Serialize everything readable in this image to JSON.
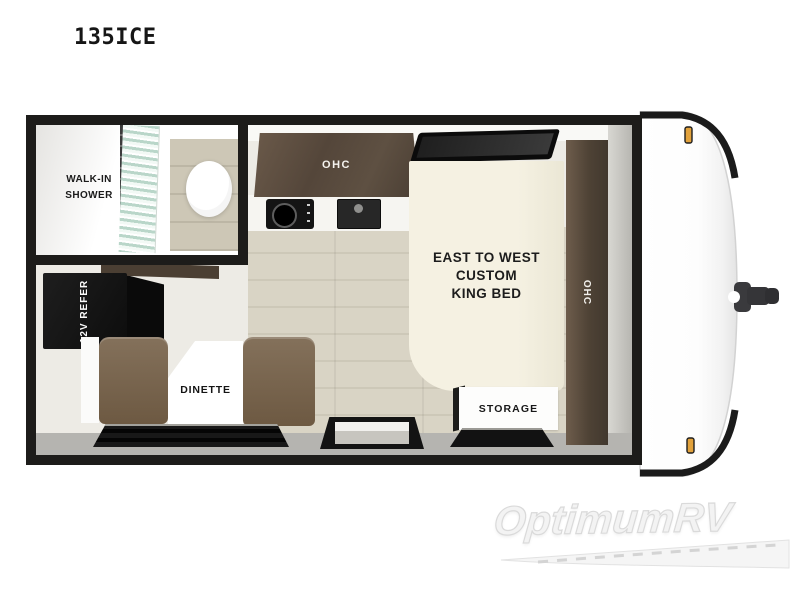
{
  "page": {
    "title": "135ICE",
    "background": "#ffffff"
  },
  "floorplan": {
    "bathroom": {
      "label_lines": [
        "WALK-IN",
        "SHOWER"
      ]
    },
    "kitchen": {
      "overhead_cabinet_label": "OHC"
    },
    "bedroom": {
      "bed_label_lines": [
        "EAST TO WEST",
        "CUSTOM",
        "KING BED"
      ],
      "wardrobe_label": "OHC",
      "storage_label": "STORAGE"
    },
    "dinette": {
      "label": "DINETTE"
    },
    "refrigerator": {
      "label": "12V REFER"
    },
    "colors": {
      "wall": "#1d1c1a",
      "floor_wood": "#d8d2c3",
      "floor_light": "#edebe5",
      "bottom_band": "#b5b4b0",
      "cabinet_wood": "#5a4b3d",
      "bench_brown": "#77634c",
      "bed_cream": "#f3efdf",
      "pillow_gray": "#d4d1c9",
      "shower_glass": "#bcd8cb",
      "fixture_black": "#141414",
      "marker_light_amber": "#e2a23c",
      "cap_white": "#ffffff",
      "hitch_gray": "#3a3a3d"
    }
  },
  "watermark": {
    "brand": "OptimumRV"
  }
}
